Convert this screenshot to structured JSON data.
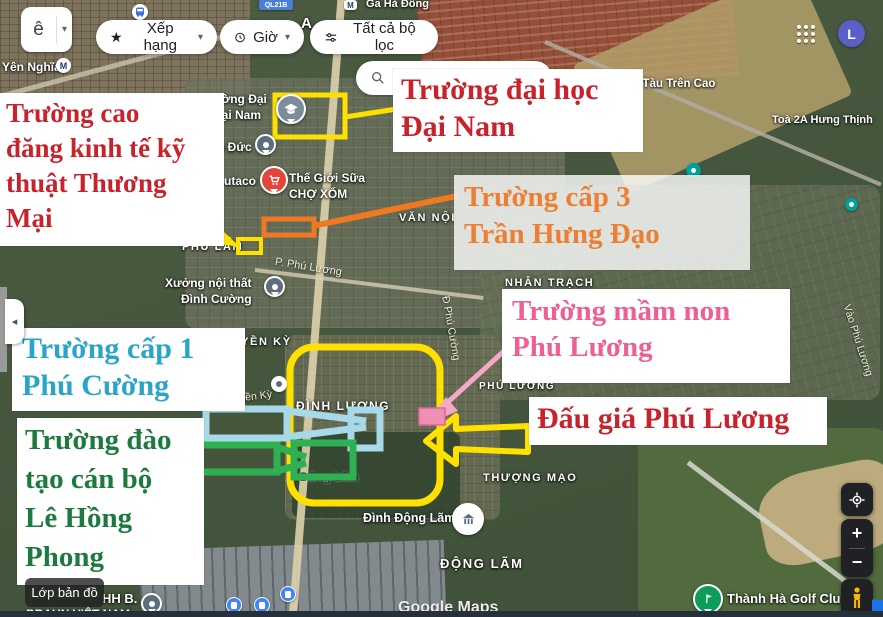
{
  "toolbar": {
    "collapsed_dropdown_text": "ê",
    "caret_glyph": "▾",
    "star_glyph": "★",
    "rating_label": "Xếp hạng",
    "hours_label": "Giờ",
    "filters_label": "Tất cả bộ lọc",
    "search_value": "Tì"
  },
  "account": {
    "avatar_letter": "L"
  },
  "icons": {
    "metro_letter": "M"
  },
  "annotations": {
    "cao_dang": {
      "color": "#c8232c",
      "lines": [
        "Trường cao",
        "đăng kinh tế kỹ",
        "thuật Thương",
        "Mại"
      ]
    },
    "dai_nam": {
      "color": "#c8232c",
      "lines": [
        "Trường đại học",
        "Đại Nam"
      ]
    },
    "cap3": {
      "color": "#ec7f33",
      "lines": [
        "Trường cấp 3",
        "Trần Hưng Đạo"
      ]
    },
    "mam_non": {
      "color": "#ee5f94",
      "lines": [
        "Trường mầm non",
        "Phú Lương"
      ]
    },
    "dau_gia": {
      "color": "#c8232c",
      "lines": [
        "Đấu giá Phú Lương"
      ]
    },
    "cap1": {
      "color": "#2aa4c9",
      "lines": [
        "Trường cấp 1",
        "Phú Cường"
      ]
    },
    "dao_tao": {
      "color": "#1d7a3f",
      "lines": [
        "Trường đào",
        "tạo cán bộ",
        "Lê Hồng",
        "Phong"
      ]
    }
  },
  "map_labels": {
    "yen_nghia": "Yên Nghĩa",
    "ql21b": "QL21B",
    "ga_ha_dong": "Ga Hà Đông",
    "partial_a": "A",
    "ga_tau_tren_cao": "t Ga Tàu Trên Cao",
    "toa_2a": "Toà 2A Hưng Thịnh",
    "dai_nam_campus_l1": "ường Đại",
    "dai_nam_campus_l2": "Đại Nam",
    "u_duc": "u Đức",
    "utaco": "utaco",
    "the_gioi_sua_l1": "Thế Giới Sữa",
    "the_gioi_sua_l2": "CHỢ XỐM",
    "phu_lam": "PHÚ LÃM",
    "van_noi": "VĂN NỘI",
    "p_phu_luong": "P. Phú Lương",
    "xuong_l1": "Xưởng nội thất",
    "xuong_l2": "Đình Cường",
    "nhan_trach": "NHÂN TRẠCH",
    "phu_luong": "PHÚ LƯƠNG",
    "d_phu_cuong": "Đ Phú Cường",
    "vao_phu_luong": "Vào Phú Lương",
    "huyen_ky": "HUYỀN KỲ",
    "huyen_ky_street": "Huyền Kỳ",
    "dinh_luong": "ĐÌNH LƯƠNG",
    "dong_lam_small": "Động Lâm",
    "thuong_mao": "THƯỢNG MẠO",
    "dinh_dong_lam": "Đình Động Lãm",
    "dong_lam": "ĐỘNG LÃM",
    "hh_b": "HH B.",
    "braun": "BRAUN VIỆT NAM",
    "golf_club": "Thành Hà Golf Clu.",
    "watermark": "Google Maps"
  },
  "controls": {
    "layers_label": "Lớp bản đồ",
    "zoom_in": "+",
    "zoom_out": "−",
    "sidebar_collapse": "◂"
  },
  "colors": {
    "highlight_yellow": "#ffe100",
    "arrow_orange": "#f07820",
    "arrow_pink": "#f3a9c4",
    "arrow_cyan": "#a8d9e9",
    "arrow_green": "#2fb052",
    "avatar_purple": "#5b5fc7"
  }
}
